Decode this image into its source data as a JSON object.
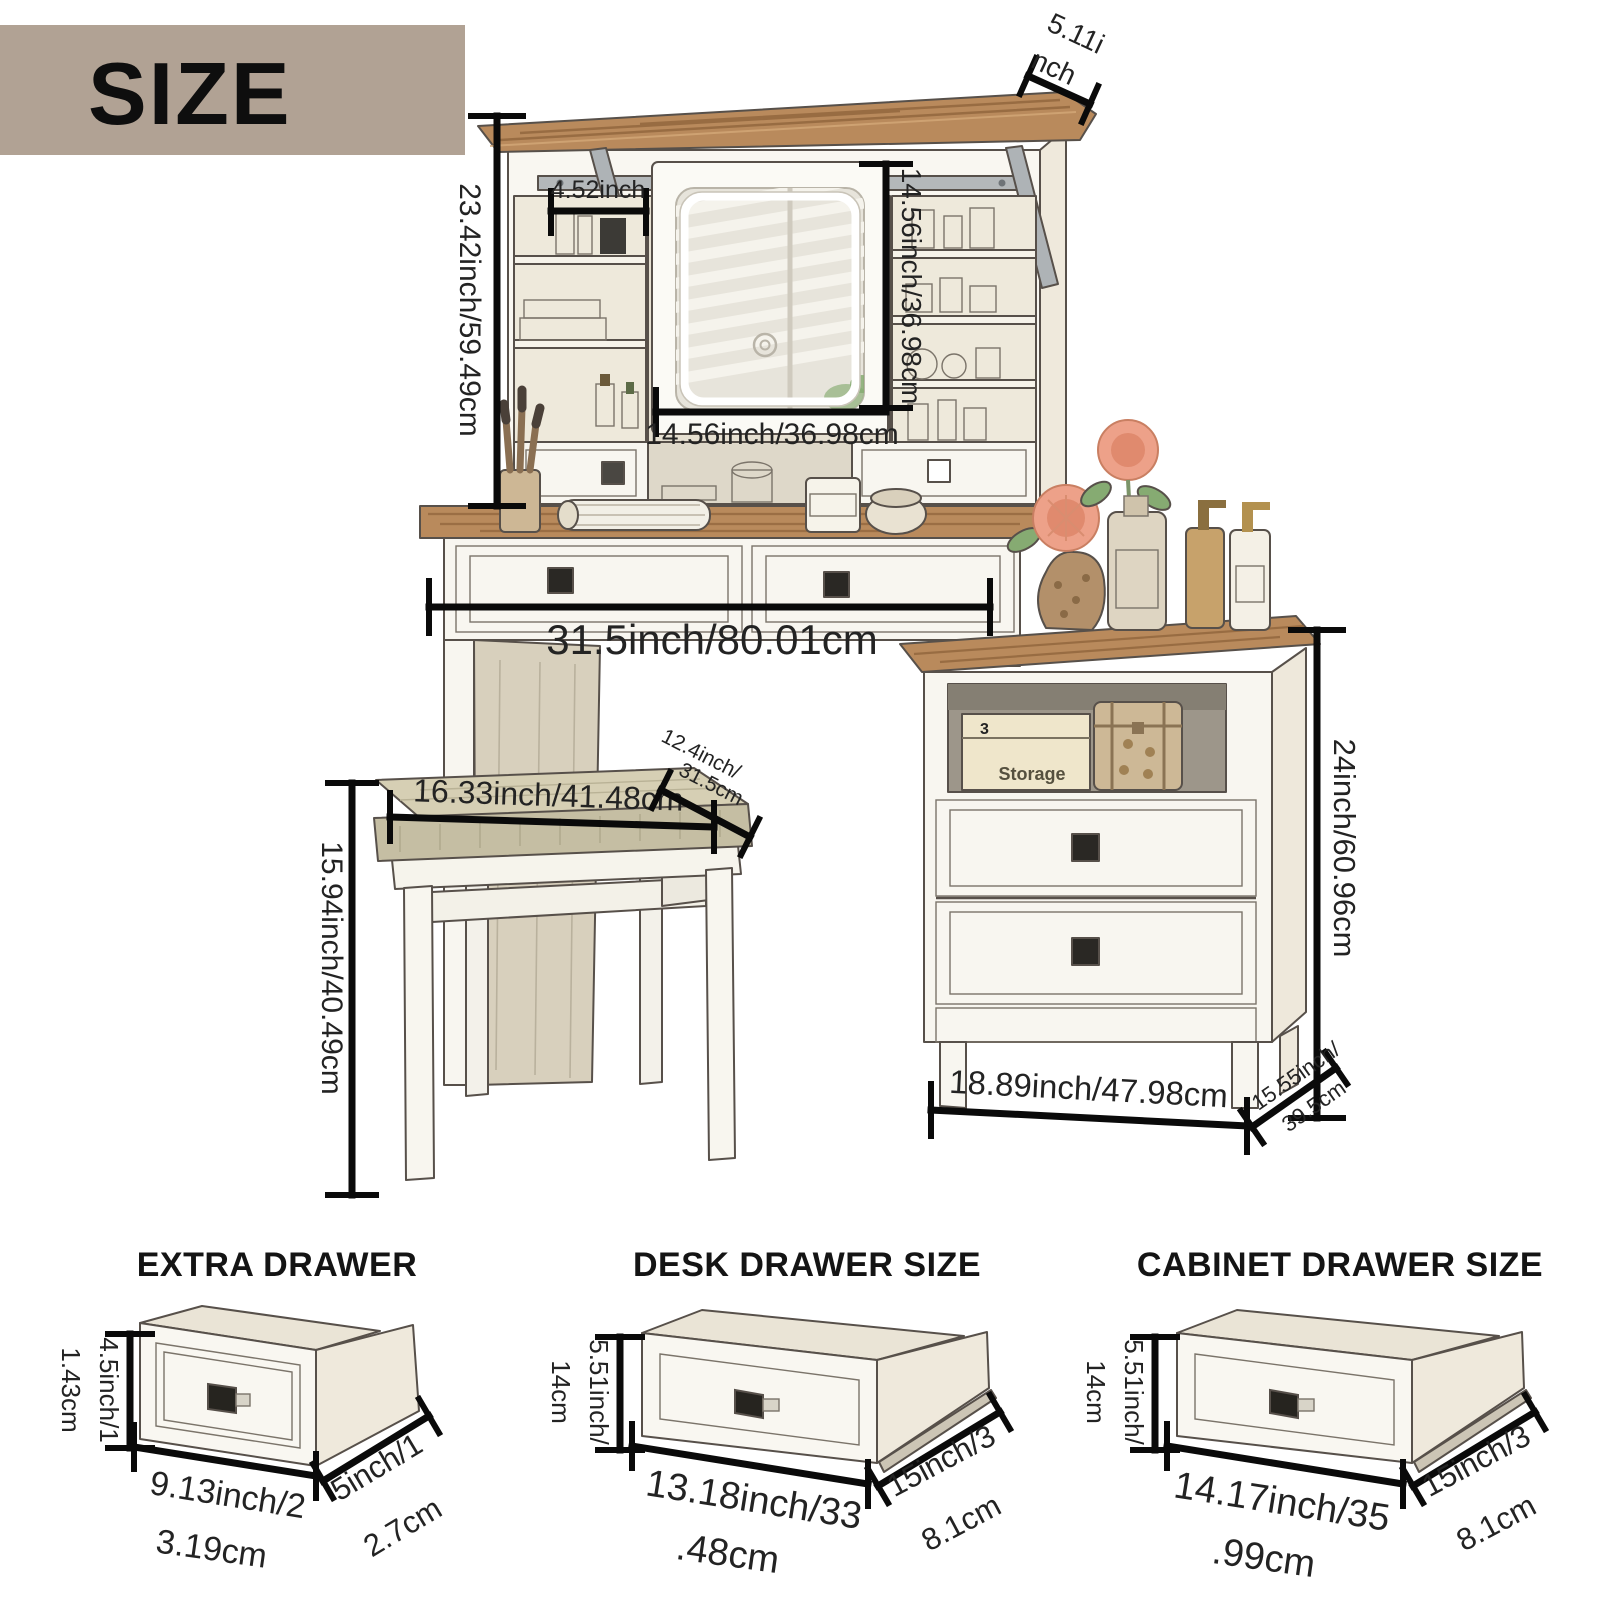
{
  "header": {
    "title": "SIZE"
  },
  "dimensions": {
    "hutch_height": "23.42inch/59.49cm",
    "shelf_width": "4.52inch",
    "mirror_height": "14.56inch/36.98cm",
    "mirror_width": "14.56inch/36.98cm",
    "hutch_top_depth": [
      "5.11i",
      "nch"
    ],
    "desk_width": "31.5inch/80.01cm",
    "stool_width": "16.33inch/41.48cm",
    "stool_depth": [
      "12.4inch/",
      "31.5cm"
    ],
    "stool_height": "15.94inch/40.49cm",
    "cabinet_height": "24inch/60.96cm",
    "cabinet_width": "18.89inch/47.98cm",
    "cabinet_depth": [
      "15.55inch/",
      "39.5cm"
    ]
  },
  "decor": {
    "storage_box_number": "3",
    "storage_box_label": "Storage"
  },
  "drawer_sections": [
    {
      "title": "EXTRA DRAWER",
      "height": [
        "4.5inch/1",
        "1.43cm"
      ],
      "width": [
        "9.13inch/2",
        "3.19cm"
      ],
      "depth": [
        "5inch/1",
        "2.7cm"
      ]
    },
    {
      "title": "DESK DRAWER SIZE",
      "height": [
        "5.51inch/",
        "14cm"
      ],
      "width": [
        "13.18inch/33",
        ".48cm"
      ],
      "depth": [
        "15inch/3",
        "8.1cm"
      ]
    },
    {
      "title": "CABINET DRAWER SIZE",
      "height": [
        "5.51inch/",
        "14cm"
      ],
      "width": [
        "14.17inch/35",
        ".99cm"
      ],
      "depth": [
        "15inch/3",
        "8.1cm"
      ]
    }
  ],
  "colors": {
    "header_bar": "#b1a294",
    "dimension_line": "#0a0a0a",
    "wood": "#b98a5c",
    "cushion": "#cbc4a9",
    "body_cream": "#f9f7f1"
  }
}
